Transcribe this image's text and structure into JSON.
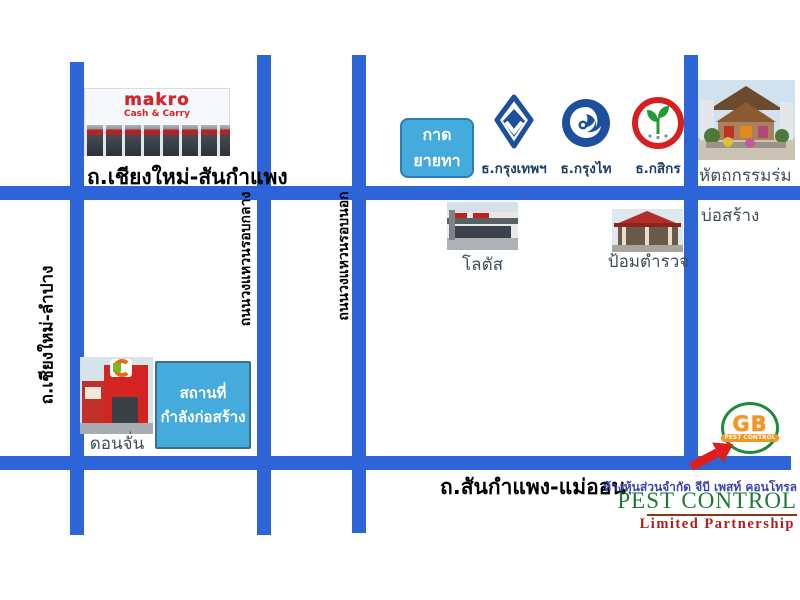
{
  "map": {
    "roads": {
      "top_label": "ถ.เชียงใหม่-สันกำแพง",
      "bottom_label": "ถ.สันกำแพง-แม่ออน",
      "left_vertical_label": "ถ.เชียงใหม่-ลำปาง",
      "ring_middle_label": "ถนนวงแหวนรอบกลาง",
      "ring_outer_label": "ถนนวงแหวนรอบนอก",
      "road_color": "#2d64d7"
    },
    "places": {
      "makro": {
        "line1": "makro",
        "line2": "Cash & Carry"
      },
      "kad_yai_tha": {
        "line1": "กาด",
        "line2": "ยายทา"
      },
      "banks": [
        {
          "name": "ธ.กรุงเทพฯ"
        },
        {
          "name": "ธ.กรุงไท"
        },
        {
          "name": "ธ.กสิกร"
        }
      ],
      "umbrella_label": "หัตถกรรมร่ม",
      "bosang_label": "บ่อสร้าง",
      "lotus_label": "โลตัส",
      "police_label": "ป้อมตำรวจ",
      "donchan_label": "ดอนจั่น",
      "construction": {
        "line1": "สถานที่",
        "line2": "กำลังก่อสร้าง"
      }
    },
    "company": {
      "logo_text": "GB",
      "logo_sub": "PEST CONTROL",
      "thai_name": "ห้างหุ้นส่วนจำกัด จีบี เพสท์ คอนโทรล",
      "name_en": "PEST CONTROL",
      "type_en": "Limited Partnership",
      "accent_green": "#1e7a34",
      "accent_orange": "#f5941e",
      "accent_red": "#b11d1d",
      "arrow_red": "#e01d1d",
      "name_blue": "#3c46ad"
    }
  }
}
